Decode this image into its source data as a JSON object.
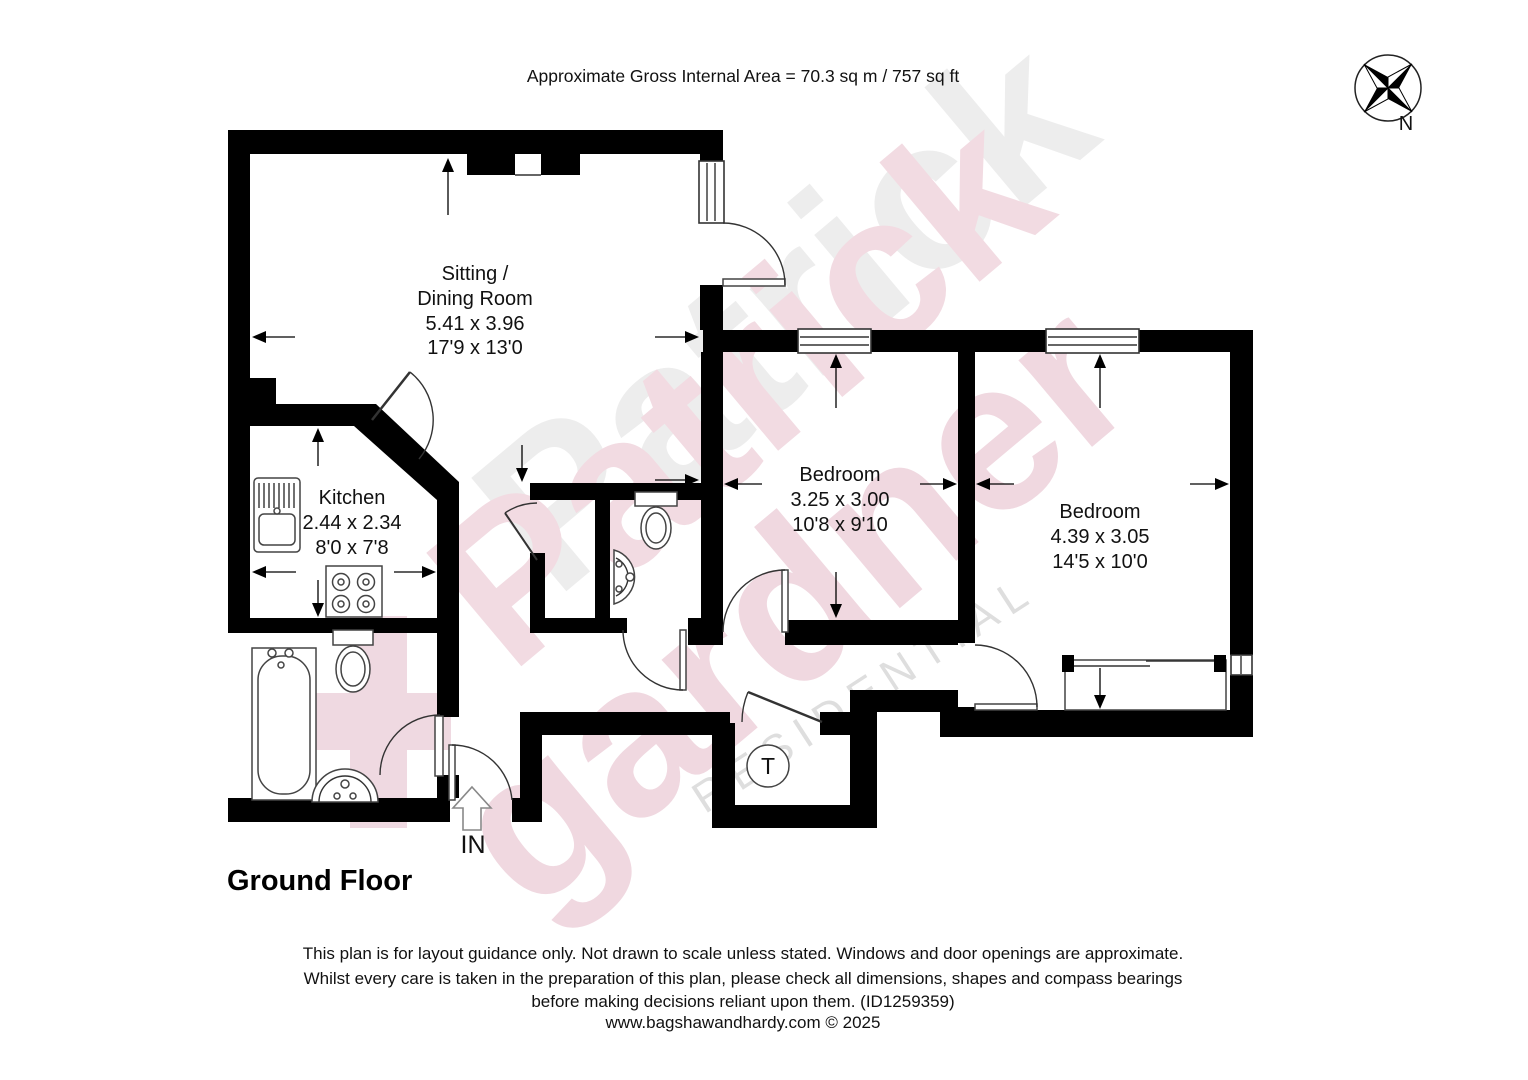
{
  "header": {
    "area_text": "Approximate Gross Internal Area = 70.3 sq m / 757 sq ft"
  },
  "compass": {
    "north_label": "N"
  },
  "watermark": {
    "brand_word1": "Patrick",
    "brand_word2": "gardner",
    "brand_word3": "RESIDENTIAL"
  },
  "rooms": {
    "sitting_dining": {
      "name_line1": "Sitting /",
      "name_line2": "Dining Room",
      "size_metric": "5.41 x 3.96",
      "size_imperial": "17'9 x 13'0"
    },
    "kitchen": {
      "name": "Kitchen",
      "size_metric": "2.44 x 2.34",
      "size_imperial": "8'0 x 7'8"
    },
    "bedroom_1": {
      "name": "Bedroom",
      "size_metric": "3.25 x 3.00",
      "size_imperial": "10'8 x 9'10"
    },
    "bedroom_2": {
      "name": "Bedroom",
      "size_metric": "4.39 x 3.05",
      "size_imperial": "14'5 x 10'0"
    }
  },
  "plan": {
    "entrance_label": "IN",
    "tank_label": "T",
    "floor_label": "Ground Floor"
  },
  "footer": {
    "disclaimer_line1": "This plan is for layout guidance only. Not drawn to scale unless stated. Windows and door openings are approximate.",
    "disclaimer_line2": "Whilst every care is taken in the preparation of this plan, please check all dimensions, shapes and compass bearings",
    "disclaimer_line3": "before making decisions reliant upon them. (ID1259359)",
    "credit": "www.bagshawandhardy.com © 2025"
  }
}
